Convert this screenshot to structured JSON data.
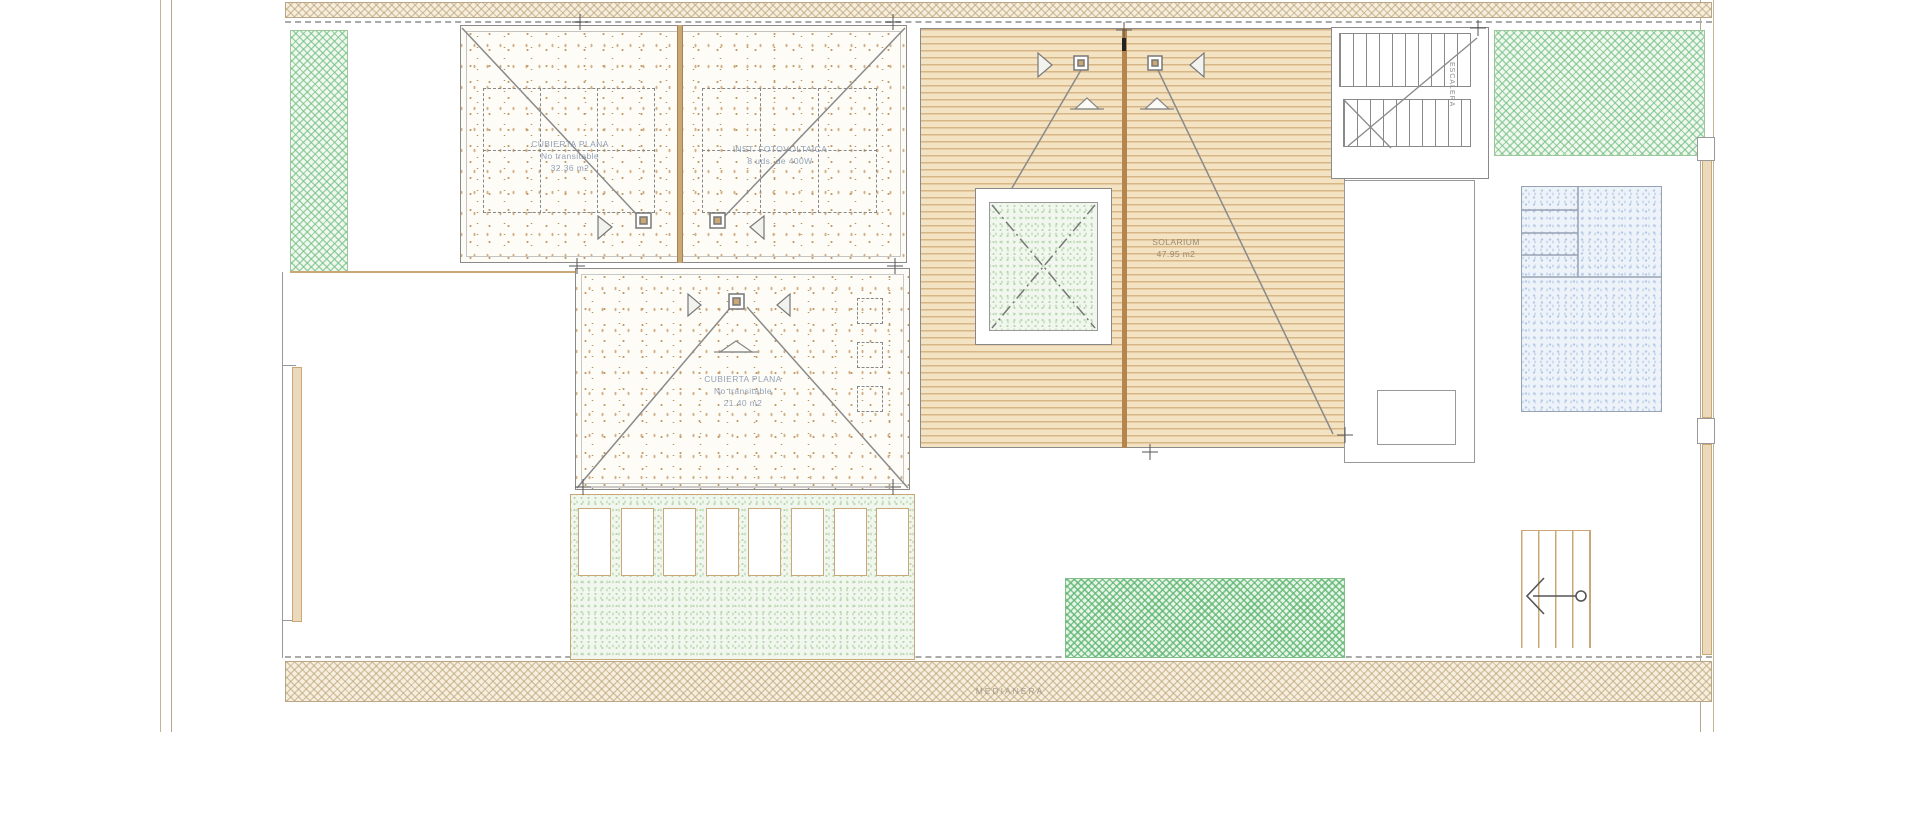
{
  "labels": {
    "roof_flat_left": {
      "name": "CUBIERTA PLANA",
      "note": "No transitable",
      "area": "32.36 m2"
    },
    "roof_pv": {
      "name": "INST. FOTOVOLTAICA",
      "note": "8 uds. de 400W"
    },
    "roof_flat_mid": {
      "name": "CUBIERTA PLANA",
      "note": "No transitable",
      "area": "21.40 m2"
    },
    "solarium": {
      "name": "SOLARIUM",
      "area": "47.95 m2"
    },
    "party_wall": "MEDIANERA",
    "staircase": "ESCALERA"
  },
  "icons": {
    "drain": "roof-drain-square",
    "slope_arrow": "slope-direction-triangle",
    "stair_arrow": "stair-direction-arrow"
  },
  "colors": {
    "deck_base": "#f3e3c3",
    "deck_line": "#d8b584",
    "deck_divider": "#b5854e",
    "hatch_wall": "#b9a073",
    "hatch_green": "#6ebe7d",
    "pool_blue": "#b4c9e6",
    "line_gray": "#8a8a8a",
    "label_blue": "#93a2b8",
    "label_brown": "#9a8a72"
  }
}
